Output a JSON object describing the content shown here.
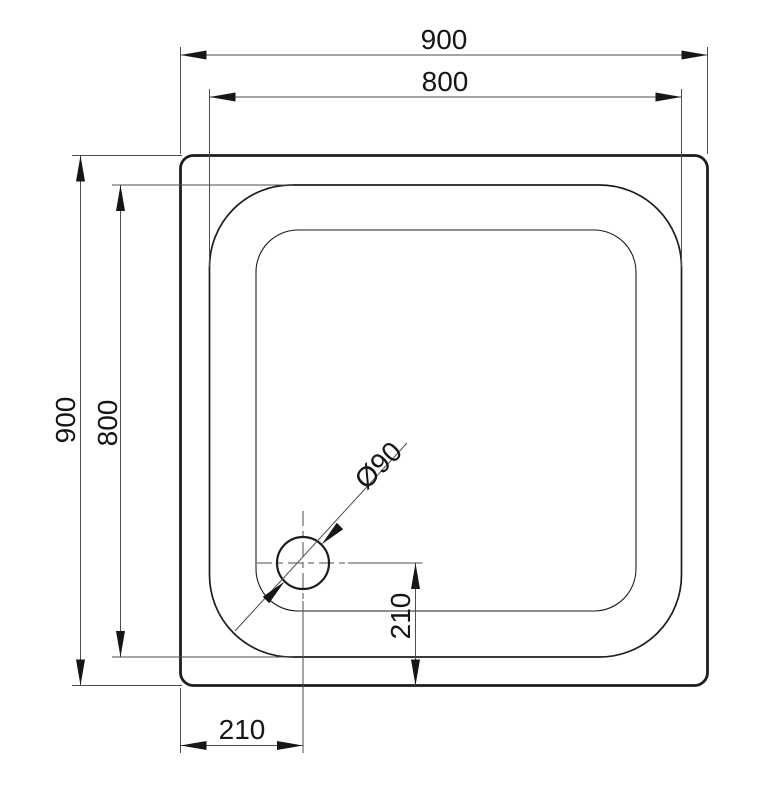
{
  "drawing": {
    "type": "technical-plan-drawing",
    "subject": "square shower tray with corner drain",
    "colors": {
      "background": "#ffffff",
      "object_line": "#1d1d1b",
      "dimension_line": "#4d4d4d",
      "text": "#161616"
    },
    "dimensions": {
      "top_outer": {
        "label": "900",
        "value": 900,
        "orientation": "horizontal",
        "measures": "overall width"
      },
      "top_inner": {
        "label": "800",
        "value": 800,
        "orientation": "horizontal",
        "measures": "inner rim width"
      },
      "left_outer": {
        "label": "900",
        "value": 900,
        "orientation": "vertical",
        "measures": "overall depth"
      },
      "left_inner": {
        "label": "800",
        "value": 800,
        "orientation": "vertical",
        "measures": "inner rim depth"
      },
      "drain": {
        "label": "Ø90",
        "value": 90,
        "orientation": "diagonal",
        "measures": "drain hole diameter"
      },
      "bottom_offset": {
        "label": "210",
        "value": 210,
        "orientation": "horizontal",
        "measures": "drain center from left edge"
      },
      "right_offset": {
        "label": "210",
        "value": 210,
        "orientation": "vertical",
        "measures": "drain center from bottom edge"
      }
    }
  }
}
